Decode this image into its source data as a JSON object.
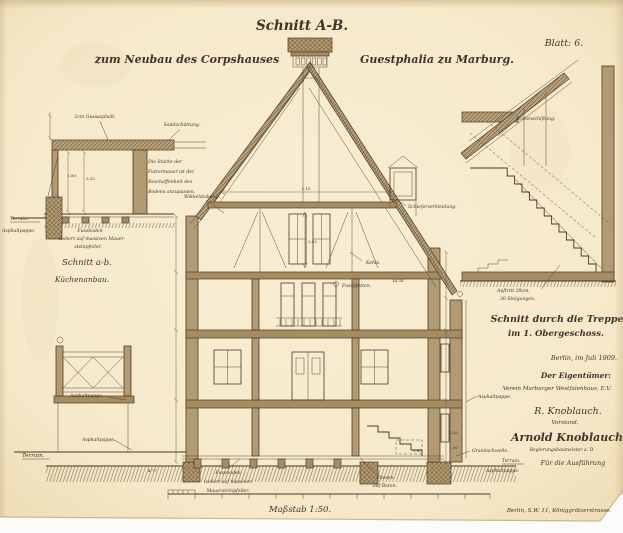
{
  "sheet": {
    "title": "Schnitt A-B.",
    "subtitle_left": "zum Neubau des Corpshauses",
    "subtitle_right": "Guestphalia zu Marburg.",
    "number": "Blatt: 6.",
    "scale": "Maßstab 1:50."
  },
  "left_detail": {
    "caption_line1": "Schnitt a-b.",
    "caption_line2": "Küchenanbau.",
    "label_gussasphalt": "2cm Gussasphalt.",
    "label_schuettung": "Sandschüttung.",
    "note_line1": "Die Stärke der",
    "note_line2": "Futtermauer ist der",
    "note_line3": "Beschaffenheit des",
    "note_line4": "Bodens anzupassen.",
    "label_terrain": "Terrain.",
    "label_asphaltpappe": "Asphaltpappe.",
    "footnote_line1": "Fussboden",
    "footnote_line2": "isoliert auf massiven Mauer-",
    "footnote_line3": "steinpfeiler."
  },
  "main_section": {
    "label_wikkelstakung": "Wikkelstakung.",
    "label_kehle": "Kehle.",
    "label_fusspfetten": "Fusspfetten.",
    "label_schiefer": "Schieferverkleidung.",
    "label_terrain_left": "Terrain.",
    "label_asphaltpappe_left_1": "Asphaltpappe.",
    "label_asphaltpappe_left_2": "Asphaltpappe.",
    "footnote_line1": "Fussboden",
    "footnote_line2": "isoliert auf massiven",
    "footnote_line3": "Mauersteinpfeiler.",
    "label_fliesen_line1": "Fliesen",
    "label_fliesen_line2": "auf Beton.",
    "label_granitschwelle": "Granitschwelle.",
    "label_terrain_right": "Terrain.",
    "label_asphaltpappe_right_1": "Asphaltpappe.",
    "label_asphaltpappe_right_2": "Asphaltpappe."
  },
  "stair_detail": {
    "label_bohlenschiftung": "Bohlenschiftung.",
    "label_auftritt_line1": "Auftritt 28cm,",
    "label_auftritt_line2": "30 Steigungen.",
    "caption_line1": "Schnitt durch die Treppe",
    "caption_line2": "im 1. Obergeschoss."
  },
  "footer": {
    "date": "Berlin, im Juli 1909.",
    "owner_heading": "Der Eigentümer:",
    "owner_name": "Verein Marburger Westfalenhaus, E.V.",
    "signature1": "R. Knoblauch.",
    "signature1_role": "Vorstand.",
    "signature2": "Arnold Knoblauch",
    "signature2_role": "Regierungsbaumeister a. D.",
    "execution_note": "Für die Ausführung",
    "address": "Berlin, S.W. 11, Königgrätzerstrasse."
  },
  "dims": [
    "3,52",
    "1,80",
    "3,10",
    "2,52",
    "2,20",
    "1,00",
    "0,47",
    "4,77",
    "14,34"
  ],
  "colors": {
    "paper": "#f7ebcd",
    "paper_edge": "#e4cea5",
    "ink": "#46362a",
    "wall": "#b29a72",
    "beam": "#a68c61"
  }
}
